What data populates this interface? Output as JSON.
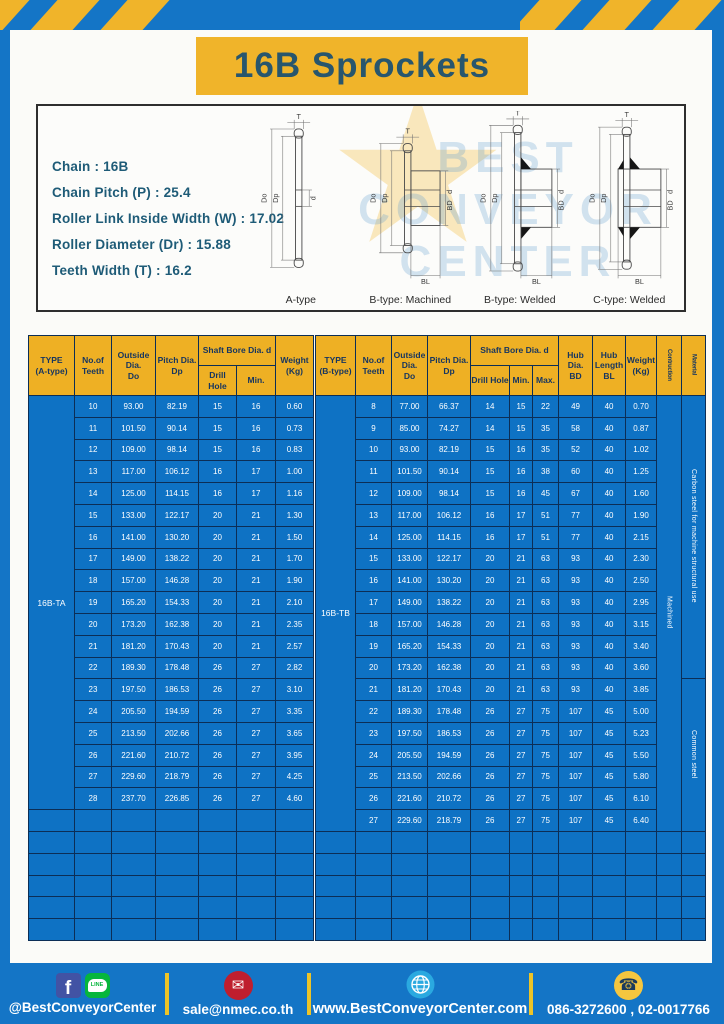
{
  "page_title": "16B Sprockets",
  "specs": {
    "lines": [
      "Chain : 16B",
      "Chain Pitch (P) : 25.4",
      "Roller Link Inside Width (W) : 17.02",
      "Roller Diameter (Dr) : 15.88",
      "Teeth Width (T) : 16.2"
    ]
  },
  "diagrams": {
    "watermark_lines": [
      "BEST",
      "CONVEYOR",
      "CENTER"
    ],
    "watermark_star": "★",
    "captions": [
      "A-type",
      "B-type: Machined",
      "B-type: Welded",
      "C-type: Welded"
    ],
    "labels": {
      "t": "T",
      "outside": "Do",
      "pitch": "Dp",
      "bore": "d",
      "hub_dia": "BD",
      "hub_len": "BL"
    }
  },
  "table_a": {
    "type_label": "16B-TA",
    "headers": {
      "type": "TYPE\n(A-type)",
      "teeth": "No.of\nTeeth",
      "outside": "Outside\nDia.\nDo",
      "pitch": "Pitch Dia.\nDp",
      "shaft_bore": "Shaft Bore Dia. d",
      "drill": "Drill Hole",
      "min": "Min.",
      "weight": "Weight\n(Kg)"
    },
    "rows": [
      [
        "10",
        "93.00",
        "82.19",
        "15",
        "16",
        "0.60"
      ],
      [
        "11",
        "101.50",
        "90.14",
        "15",
        "16",
        "0.73"
      ],
      [
        "12",
        "109.00",
        "98.14",
        "15",
        "16",
        "0.83"
      ],
      [
        "13",
        "117.00",
        "106.12",
        "16",
        "17",
        "1.00"
      ],
      [
        "14",
        "125.00",
        "114.15",
        "16",
        "17",
        "1.16"
      ],
      [
        "15",
        "133.00",
        "122.17",
        "20",
        "21",
        "1.30"
      ],
      [
        "16",
        "141.00",
        "130.20",
        "20",
        "21",
        "1.50"
      ],
      [
        "17",
        "149.00",
        "138.22",
        "20",
        "21",
        "1.70"
      ],
      [
        "18",
        "157.00",
        "146.28",
        "20",
        "21",
        "1.90"
      ],
      [
        "19",
        "165.20",
        "154.33",
        "20",
        "21",
        "2.10"
      ],
      [
        "20",
        "173.20",
        "162.38",
        "20",
        "21",
        "2.35"
      ],
      [
        "21",
        "181.20",
        "170.43",
        "20",
        "21",
        "2.57"
      ],
      [
        "22",
        "189.30",
        "178.48",
        "26",
        "27",
        "2.82"
      ],
      [
        "23",
        "197.50",
        "186.53",
        "26",
        "27",
        "3.10"
      ],
      [
        "24",
        "205.50",
        "194.59",
        "26",
        "27",
        "3.35"
      ],
      [
        "25",
        "213.50",
        "202.66",
        "26",
        "27",
        "3.65"
      ],
      [
        "26",
        "221.60",
        "210.72",
        "26",
        "27",
        "3.95"
      ],
      [
        "27",
        "229.60",
        "218.79",
        "26",
        "27",
        "4.25"
      ],
      [
        "28",
        "237.70",
        "226.85",
        "26",
        "27",
        "4.60"
      ]
    ],
    "empty_rows": 6
  },
  "table_b": {
    "type_label": "16B-TB",
    "headers": {
      "type": "TYPE\n(B-type)",
      "teeth": "No.of\nTeeth",
      "outside": "Outside\nDia.\nDo",
      "pitch": "Pitch Dia.\nDp",
      "shaft_bore": "Shaft Bore Dia. d",
      "drill": "Drill Hole",
      "min": "Min.",
      "max": "Max.",
      "hub_dia": "Hub Dia.\nBD",
      "hub_len": "Hub\nLength\nBL",
      "weight": "Weight\n(Kg)",
      "construction": "Contruction",
      "material": "Material"
    },
    "rows": [
      [
        "8",
        "77.00",
        "66.37",
        "14",
        "15",
        "22",
        "49",
        "40",
        "0.70"
      ],
      [
        "9",
        "85.00",
        "74.27",
        "14",
        "15",
        "35",
        "58",
        "40",
        "0.87"
      ],
      [
        "10",
        "93.00",
        "82.19",
        "15",
        "16",
        "35",
        "52",
        "40",
        "1.02"
      ],
      [
        "11",
        "101.50",
        "90.14",
        "15",
        "16",
        "38",
        "60",
        "40",
        "1.25"
      ],
      [
        "12",
        "109.00",
        "98.14",
        "15",
        "16",
        "45",
        "67",
        "40",
        "1.60"
      ],
      [
        "13",
        "117.00",
        "106.12",
        "16",
        "17",
        "51",
        "77",
        "40",
        "1.90"
      ],
      [
        "14",
        "125.00",
        "114.15",
        "16",
        "17",
        "51",
        "77",
        "40",
        "2.15"
      ],
      [
        "15",
        "133.00",
        "122.17",
        "20",
        "21",
        "63",
        "93",
        "40",
        "2.30"
      ],
      [
        "16",
        "141.00",
        "130.20",
        "20",
        "21",
        "63",
        "93",
        "40",
        "2.50"
      ],
      [
        "17",
        "149.00",
        "138.22",
        "20",
        "21",
        "63",
        "93",
        "40",
        "2.95"
      ],
      [
        "18",
        "157.00",
        "146.28",
        "20",
        "21",
        "63",
        "93",
        "40",
        "3.15"
      ],
      [
        "19",
        "165.20",
        "154.33",
        "20",
        "21",
        "63",
        "93",
        "40",
        "3.40"
      ],
      [
        "20",
        "173.20",
        "162.38",
        "20",
        "21",
        "63",
        "93",
        "40",
        "3.60"
      ],
      [
        "21",
        "181.20",
        "170.43",
        "20",
        "21",
        "63",
        "93",
        "40",
        "3.85"
      ],
      [
        "22",
        "189.30",
        "178.48",
        "26",
        "27",
        "75",
        "107",
        "45",
        "5.00"
      ],
      [
        "23",
        "197.50",
        "186.53",
        "26",
        "27",
        "75",
        "107",
        "45",
        "5.23"
      ],
      [
        "24",
        "205.50",
        "194.59",
        "26",
        "27",
        "75",
        "107",
        "45",
        "5.50"
      ],
      [
        "25",
        "213.50",
        "202.66",
        "26",
        "27",
        "75",
        "107",
        "45",
        "5.80"
      ],
      [
        "26",
        "221.60",
        "210.72",
        "26",
        "27",
        "75",
        "107",
        "45",
        "6.10"
      ],
      [
        "27",
        "229.60",
        "218.79",
        "26",
        "27",
        "75",
        "107",
        "45",
        "6.40"
      ]
    ],
    "construction": "Machined",
    "materials": [
      {
        "label": "Carbon steel for machine structural use",
        "rows": 13
      },
      {
        "label": "Common steel",
        "rows": 7
      }
    ],
    "empty_rows": 5
  },
  "footer": {
    "social": "@BestConveyorCenter",
    "email": "sale@nmec.co.th",
    "website": "www.BestConveyorCenter.com",
    "phone": "086-3272600 , 02-0017766"
  },
  "colors": {
    "frame_blue": "#1475c6",
    "cell_blue": "#0e72c4",
    "grid_navy": "#0c2e56",
    "header_yellow": "#eeb024",
    "banner_yellow": "#f0b42a",
    "spec_teal": "#1e5b77",
    "title_teal": "#28566d"
  }
}
